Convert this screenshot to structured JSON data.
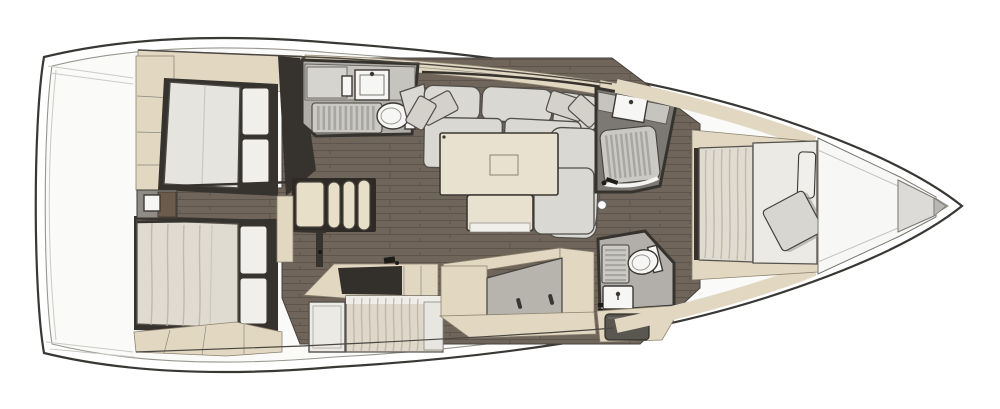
{
  "canvas": {
    "width": 1000,
    "height": 409,
    "background": "#ffffff"
  },
  "plan": {
    "type": "yacht-interior-floor-plan",
    "view": "top-down",
    "bow_direction": "right",
    "areas": [
      {
        "id": "aft-cabin-port",
        "furniture": [
          "double-bed",
          "two-pillows",
          "wardrobe",
          "overhead-lockers"
        ]
      },
      {
        "id": "aft-cabin-starboard",
        "furniture": [
          "double-bed",
          "two-pillows",
          "under-bed-lockers"
        ]
      },
      {
        "id": "companionway-steps",
        "furniture": [
          "four-steps"
        ]
      },
      {
        "id": "aft-head",
        "furniture": [
          "sink",
          "shower-grate",
          "toilet",
          "counter"
        ]
      },
      {
        "id": "salon",
        "furniture": [
          "u-shaped-sofa",
          "four-throw-pillows",
          "table",
          "bench-seat"
        ]
      },
      {
        "id": "galley",
        "furniture": [
          "l-shaped-counter",
          "cooktop",
          "fridge-door",
          "fabric-bench"
        ]
      },
      {
        "id": "starboard-settee",
        "furniture": [
          "recessed-seat",
          "two-hatch-handles"
        ]
      },
      {
        "id": "forward-head-shower",
        "furniture": [
          "sink",
          "shower-grate",
          "shower-fixture"
        ]
      },
      {
        "id": "forward-head-toilet",
        "furniture": [
          "toilet",
          "shower-grate",
          "sink",
          "stowage-tray"
        ]
      },
      {
        "id": "forward-cabin",
        "furniture": [
          "island-double-bed",
          "blanket",
          "two-pillows",
          "side-shelves"
        ]
      },
      {
        "id": "bow",
        "furniture": [
          "v-berth-wedge",
          "anchor-locker"
        ]
      },
      {
        "id": "mast-post",
        "furniture": [
          "post"
        ]
      }
    ]
  },
  "colors": {
    "hull_outline": "#3a3835",
    "deck": "#fafaf9",
    "floor_wood": "#6f655b",
    "floor_plank_line": "#5d544b",
    "cabinetry_beige": "#e2d8c2",
    "upholstery_gray": "#d9d8d2",
    "mattress": "#e6e4de",
    "pillow": "#f0efeb",
    "blanket": "#e0dbd0",
    "counter_gray": "#c6c4bf",
    "grate": "#cbc9c4",
    "grate_slat": "#a8a6a1",
    "head_floor": "#b0ada8",
    "fixture_white": "#f6f6f4",
    "dark_wall": "#36332f",
    "galley_counter_dark": "#332f2a",
    "wood_shelf": "#6b5b4a",
    "table_cream": "#e9e1cf",
    "steps_cream": "#e8dfc9",
    "bench_gray": "#b7b4ae"
  }
}
